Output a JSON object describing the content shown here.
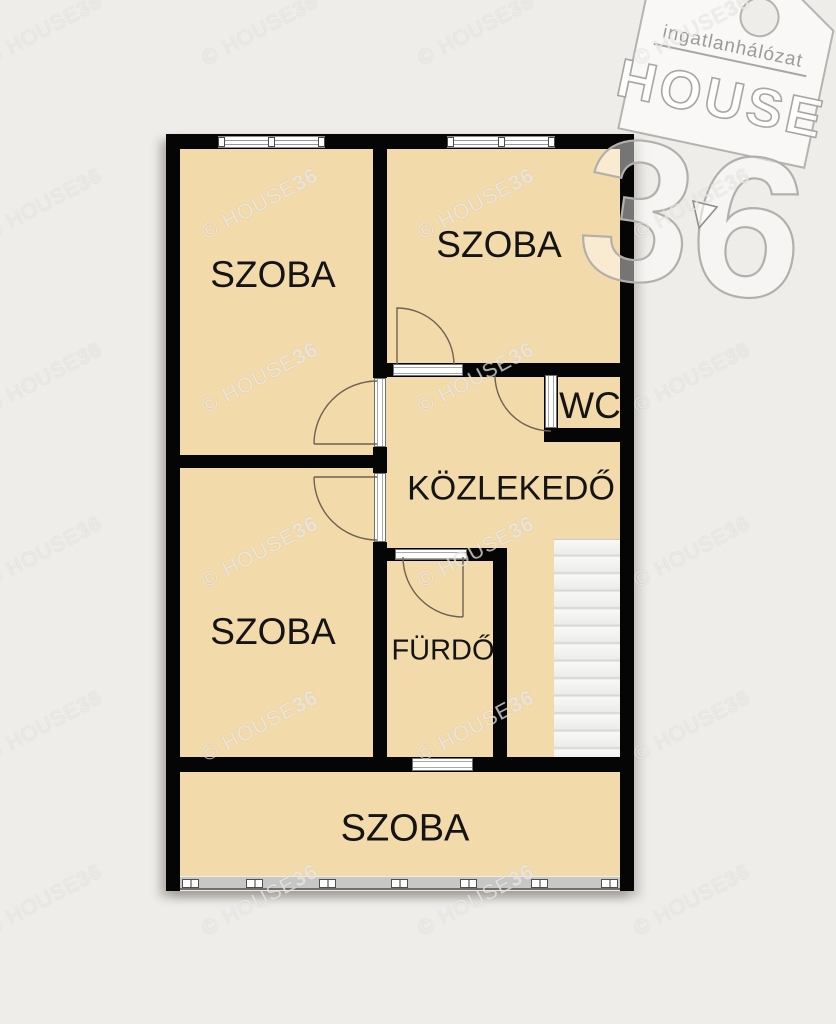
{
  "plan": {
    "rooms": {
      "top_left": {
        "label": "SZOBA"
      },
      "top_right": {
        "label": "SZOBA"
      },
      "wc": {
        "label": "WC"
      },
      "hallway": {
        "label": "KÖZLEKEDŐ"
      },
      "bottom_left": {
        "label": "SZOBA"
      },
      "bathroom": {
        "label": "FÜRDŐ"
      },
      "bottom": {
        "label": "SZOBA"
      }
    },
    "colors": {
      "room_fill": "#f3daab",
      "wall": "#050505",
      "background": "#efedea",
      "stairs": "#f4f4f2"
    }
  },
  "watermark": {
    "prefix": "© HOUSE",
    "suffix": "36"
  },
  "logo": {
    "tagline": "ingatlanhálózat",
    "brand": "HOUSE",
    "number": "36"
  }
}
